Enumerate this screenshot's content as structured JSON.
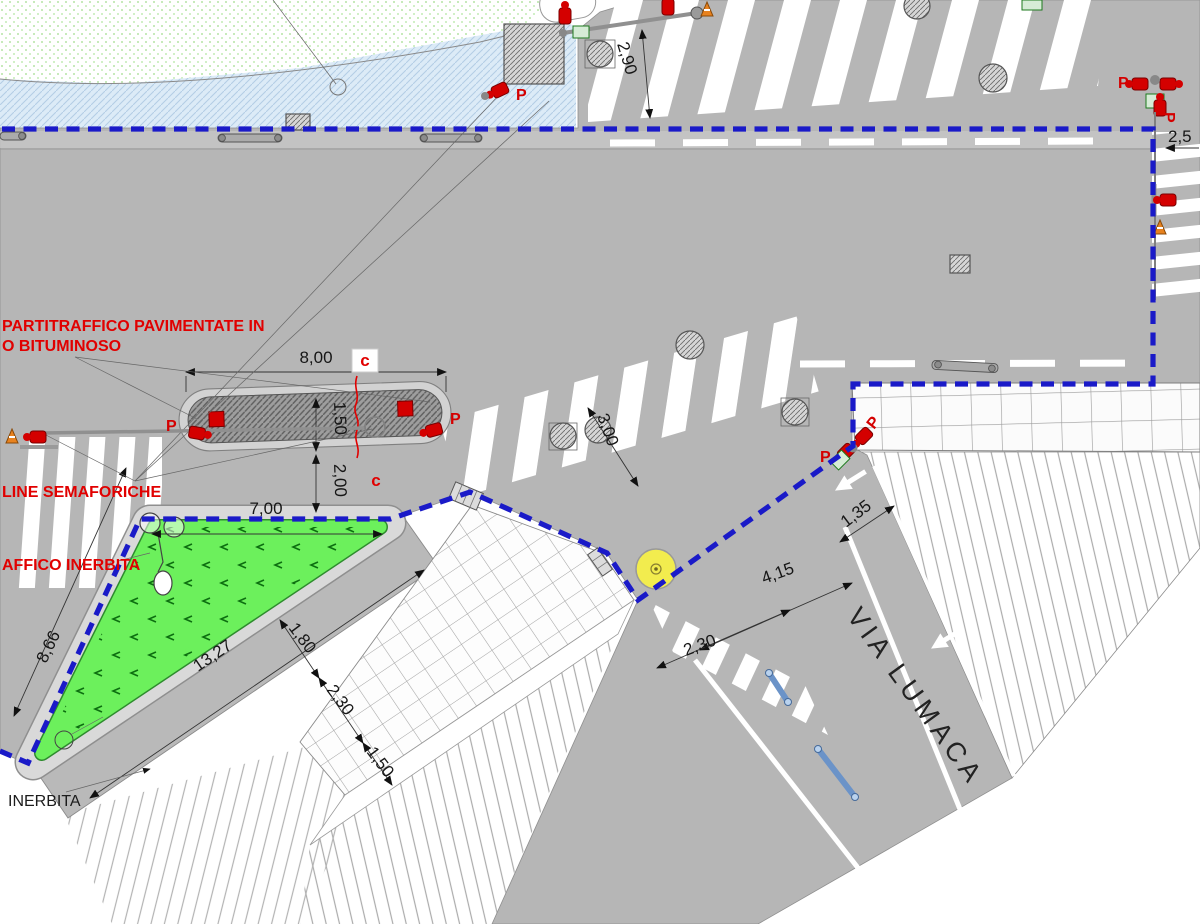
{
  "drawing": {
    "street_name": "VIA LUMACA",
    "labels": {
      "paved_divider_line1": "PARTITRAFFICO PAVIMENTATE IN",
      "paved_divider_line2": "O BITUMINOSO",
      "traffic_light_lines": "LINE SEMAFORICHE",
      "grassed_divider": "AFFICO INERBITA",
      "grassed": "INERBITA",
      "pedestrian_signal": "P",
      "section_marker": "c"
    },
    "dimensions": {
      "crosswalk_top": "2,90",
      "crosswalk_right": "2,5",
      "island_length": "8,00",
      "island_width": "1,50",
      "island_gap": "2,00",
      "triangle_top": "7,00",
      "triangle_left_side": "8,66",
      "triangle_hypotenuse": "13,27",
      "crosswalk_middle": "3,00",
      "corner_walk": "1,35",
      "via_lumaca_width": "4,15",
      "via_lumaca_crosswalk": "2,30",
      "strip_verge": "1,80",
      "strip_paver": "2,30",
      "strip_outer": "1,50"
    },
    "colors": {
      "boundary_blue": "#1a1ac8",
      "signal_red": "#d40000",
      "island_green": "#6cf05c",
      "marker_yellow": "#f2ec4e",
      "road_gray": "#b6b6b6"
    }
  }
}
